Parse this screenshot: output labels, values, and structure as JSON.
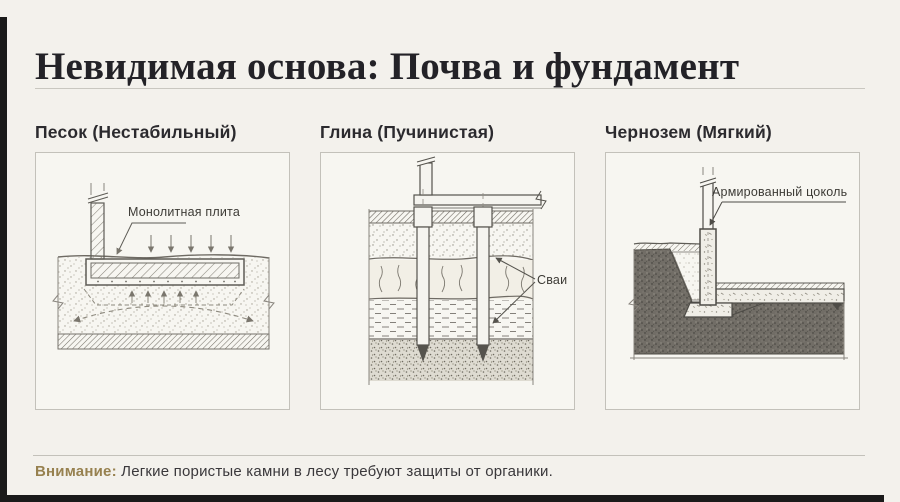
{
  "header": {
    "title": "Невидимая основа: Почва и фундамент"
  },
  "panels": [
    {
      "title": "Песок (Нестабильный)",
      "callout": "Монолитная плита"
    },
    {
      "title": "Глина (Пучинистая)",
      "callout": "Сваи"
    },
    {
      "title": "Чернозем (Мягкий)",
      "callout": "Армированный цоколь"
    }
  ],
  "footer": {
    "warning_label": "Внимание:",
    "warning_text": "Легкие пористые камни в лесу требуют защиты от органики."
  },
  "colors": {
    "background": "#f3f1ec",
    "accent_dark": "#1a1a1a",
    "warning_accent": "#97814f",
    "drawing_line": "#5c5a55"
  }
}
